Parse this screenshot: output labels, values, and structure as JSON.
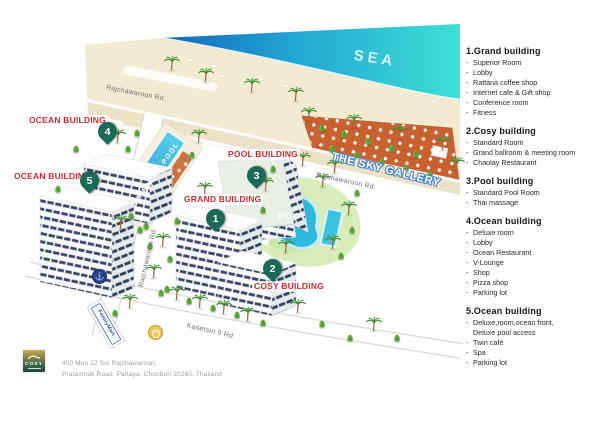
{
  "map": {
    "sea_label": "SEA",
    "sky_gallery_label": "THE SKY GALLERY",
    "swimming_pool_label": "SWIMMING POOL",
    "pool_label": "POOL",
    "familymart_label": "FamilyMart",
    "road_labels": {
      "top": "Rajchawaroon Rd.",
      "right": "Rajchawaroon Rd.",
      "vertical": "Rajchawaroon Rd.",
      "bottom": "Kasetsin 9 Rd."
    },
    "buildings": [
      {
        "num": "1",
        "label": "GRAND BUILDING"
      },
      {
        "num": "2",
        "label": "COSY BUILDING"
      },
      {
        "num": "3",
        "label": "POOL BUILDING"
      },
      {
        "num": "4",
        "label": "OCEAN BUILDING"
      },
      {
        "num": "5",
        "label": "OCEAN BUILDING"
      }
    ],
    "poi": {
      "anchor_glyph": "⚓"
    },
    "colors": {
      "sea_deep": "#1565bd",
      "sea_shallow": "#3ee0d6",
      "beach": "#f3ead2",
      "sky_gallery": "#c8602f",
      "pool_water": "#2fb9dd",
      "pin": "#1b6a57",
      "building_label": "#c42f2f",
      "window_stripe": "#3a4a61"
    }
  },
  "footer": {
    "logo_text": "COSY",
    "address_line1": "400 Moo 12 Soi Rajchawaroon,",
    "address_line2": "Pratamnuk Road, Pattaya, Chonburi 20260, Thailand"
  },
  "legend": {
    "sections": [
      {
        "title": "1.Grand building",
        "items": [
          "Superior Room",
          "Lobby",
          "Rattana coffee shop",
          "Internet cafe & Gift shop",
          "Conference room",
          "Fitness"
        ]
      },
      {
        "title": "2.Cosy building",
        "items": [
          "Standard Room",
          "Grand ballroom & meeting room",
          "Chaolay Restaurant"
        ]
      },
      {
        "title": "3.Pool building",
        "items": [
          "Standard Pool Room",
          "Thai massage"
        ]
      },
      {
        "title": "4.Ocean building",
        "items": [
          "Deluxe room",
          "Lobby",
          "Ocean Restaurant",
          "V-Lounge",
          "Shop",
          "Pizza shop",
          "Parking lot"
        ]
      },
      {
        "title": "5.Ocean building",
        "items": [
          "Deluxe,room,ocean front,\nDeluxe pool access",
          "Twin café",
          "Spa",
          "Parking lot"
        ]
      }
    ]
  }
}
